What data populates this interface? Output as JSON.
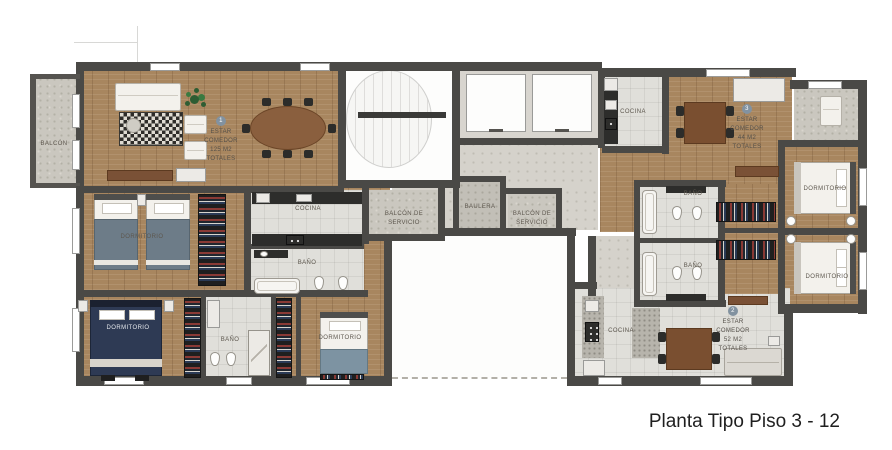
{
  "caption": "Planta Tipo Piso 3 - 12",
  "palette": {
    "wall": "#4a4946",
    "wood_floor": "#a8865f",
    "tile_floor": "#e0dfda",
    "balcony_floor": "#cac7bf",
    "navy_bed": "#2e3a54",
    "label_text": "#5d574e",
    "caption_text": "#1f1f1f",
    "unit_badge": "#8292a0"
  },
  "rooms": {
    "balcon": "BALCÓN",
    "dormitorio": "DORMITORIO",
    "cocina": "COCINA",
    "bano": "BAÑO",
    "balcon_servicio": "BALCÓN DE SERVICIO",
    "baulera": "BAULERA"
  },
  "units": [
    {
      "number": "1",
      "estar": "ESTAR",
      "comedor": "COMEDOR",
      "area": "125 M2",
      "totales": "TOTALES"
    },
    {
      "number": "2",
      "estar": "ESTAR",
      "comedor": "COMEDOR",
      "area": "52 M2",
      "totales": "TOTALES"
    },
    {
      "number": "3",
      "estar": "ESTAR",
      "comedor": "COMEDOR",
      "area": "44 M2",
      "totales": "TOTALES"
    }
  ]
}
